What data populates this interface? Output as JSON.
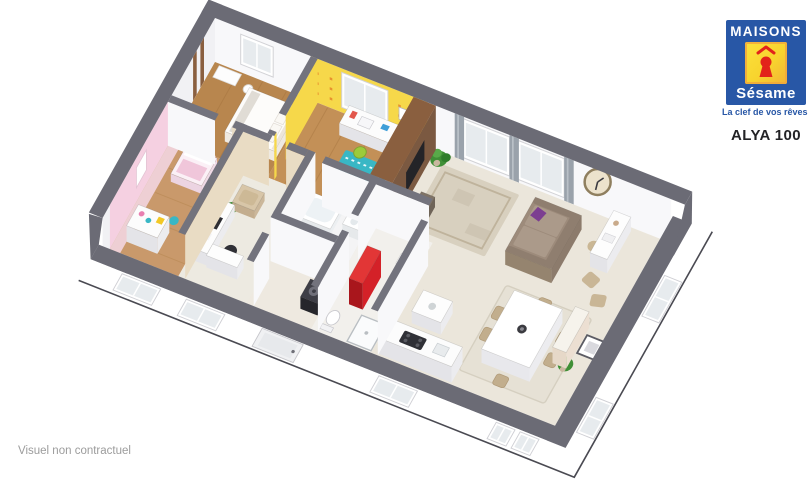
{
  "logo": {
    "brand_top": "MAISONS",
    "brand_bottom": "Sésame",
    "tagline": "La clef de vos rêves"
  },
  "model": {
    "name": "ALYA 100"
  },
  "footer": {
    "disclaimer": "Visuel non contractuel"
  },
  "colors": {
    "logo_blue": "#2857a6",
    "logo_yellow": "#f8d42e",
    "logo_red": "#e2231a",
    "wall_top": "#6b6b75",
    "wall_top_int": "#73737d",
    "wall_face": "#f8f8fa",
    "wall_face_shade": "#f1f1f4",
    "floor_base": "#ebe6db",
    "wood_dark": "#b8864e",
    "wood_mid": "#c39057",
    "wood_light": "#c9996b",
    "pink_wall": "#f5d0e1",
    "pink_floor": "#f4d8e6",
    "beige_wall": "#e9dcc4",
    "yellow_wall": "#f6d84a",
    "yellow_dot": "#e8912f",
    "brown_wall": "#7b5941",
    "brown_top": "#8a5f3f",
    "teal": "#39b7c5",
    "lime": "#9ccb3b",
    "red": "#d42128",
    "red_dark": "#a9161c",
    "purple": "#7c3e91",
    "sofa": "#9d8b7b",
    "sofa_light": "#ab9a8a",
    "rug_living": "#d8d0bf",
    "rug_dining": "#e6e1d5",
    "clock_face": "#ece2cc",
    "curtain": "#9aa2ab",
    "glass": "#e7ebee",
    "green": "#3f8f36",
    "dark": "#34343a"
  }
}
